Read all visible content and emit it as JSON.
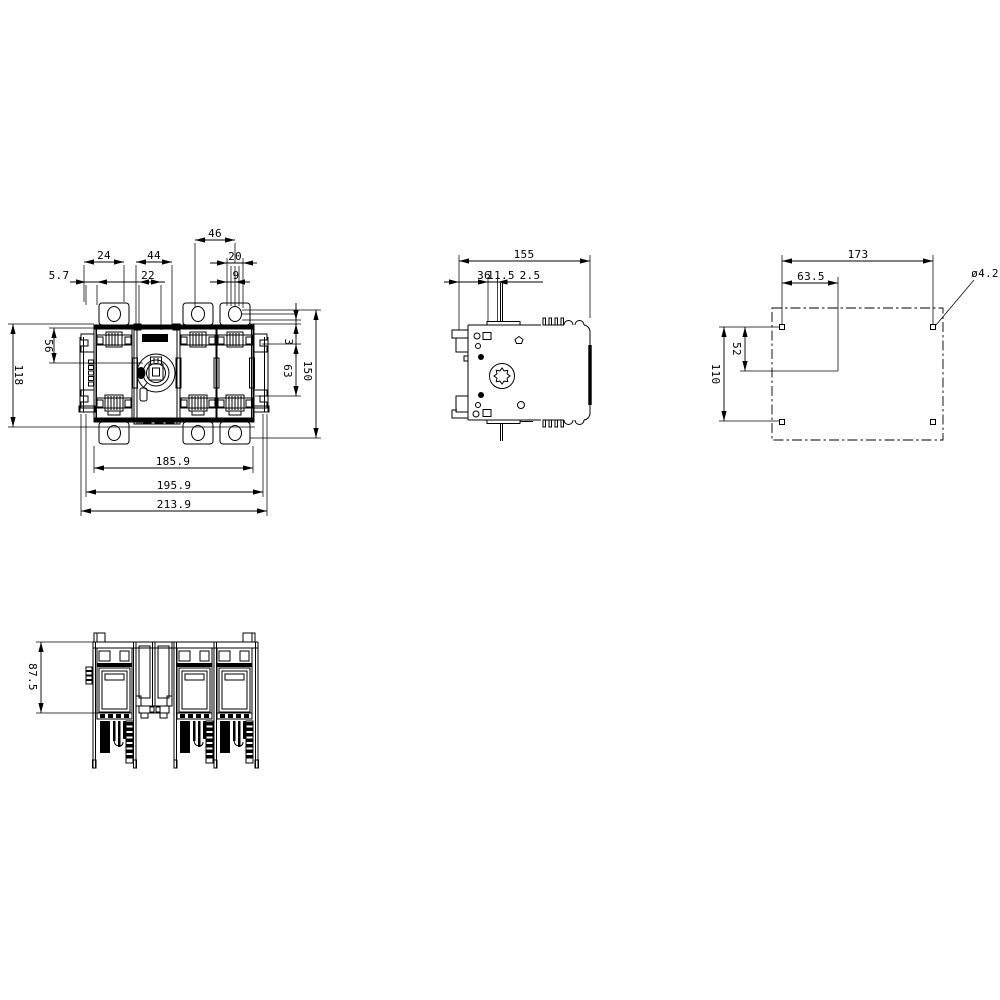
{
  "page": {
    "background": "#ffffff",
    "line_color": "#000000"
  },
  "views": {
    "front": {
      "dims": {
        "d46": "46",
        "d24": "24",
        "d44": "44",
        "d20": "20",
        "d5_7": "5.7",
        "d22": "22",
        "d9": "9",
        "d56": "56",
        "d118": "118",
        "d3": "3",
        "d63": "63",
        "d150": "150",
        "d185_9": "185.9",
        "d195_9": "195.9",
        "d213_9": "213.9"
      }
    },
    "side": {
      "dims": {
        "d155": "155",
        "d36": "36",
        "d11_5": "11.5",
        "d2_5": "2.5"
      }
    },
    "drilling": {
      "dims": {
        "d173": "173",
        "d63_5": "63.5",
        "d4_2": "ø4.2",
        "d52": "52",
        "d110": "110"
      }
    },
    "bottom": {
      "dims": {
        "d87_5": "87.5"
      }
    }
  }
}
